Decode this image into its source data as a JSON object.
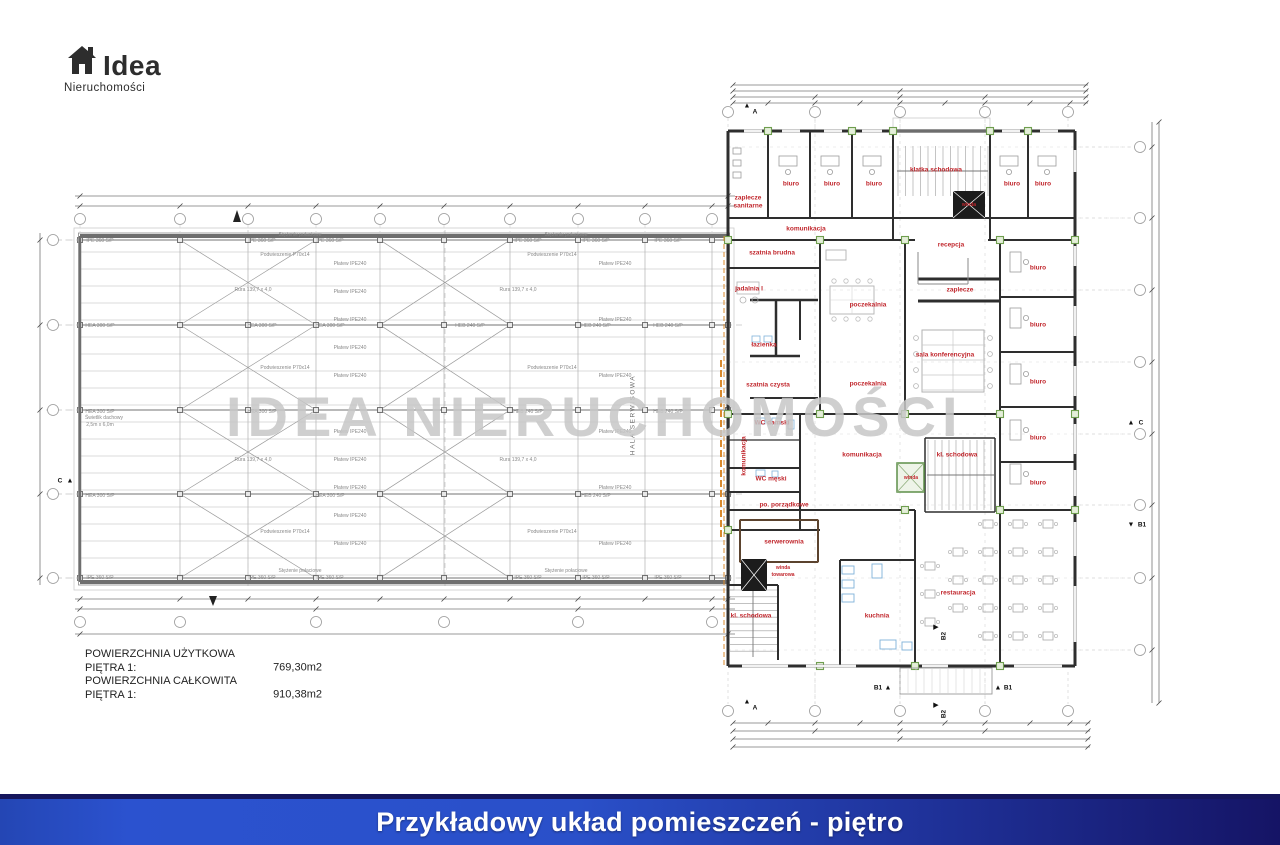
{
  "logo": {
    "brand": "Idea",
    "subtitle": "Nieruchomości"
  },
  "watermark": {
    "text": "IDEA NIERUCHOMOŚCI"
  },
  "summary": {
    "rows": [
      {
        "label": "POWIERZCHNIA UŻYTKOWA PIĘTRA 1:",
        "value": "769,30m2"
      },
      {
        "label": "POWIERZCHNIA CAŁKOWITA PIĘTRA 1:",
        "value": "910,38m2"
      }
    ]
  },
  "banner": {
    "text": "Przykładowy układ pomieszczeń - piętro"
  },
  "colors": {
    "room_label_red": "#c1272d",
    "banner_left": "#2b52cf",
    "banner_right": "#151465",
    "watermark_gray": "#c7c7c7",
    "green_marker": "#6f9e4f",
    "fire_line_orange": "#d98a2e"
  },
  "layers": {
    "rooms": [
      {
        "text": "zaplecze",
        "x": 748,
        "y": 198
      },
      {
        "text": "sanitarne",
        "x": 748,
        "y": 206
      },
      {
        "text": "biuro",
        "x": 791,
        "y": 184
      },
      {
        "text": "biuro",
        "x": 832,
        "y": 184
      },
      {
        "text": "biuro",
        "x": 874,
        "y": 184
      },
      {
        "text": "klatka schodowa",
        "x": 936,
        "y": 170
      },
      {
        "text": "biuro",
        "x": 1012,
        "y": 184
      },
      {
        "text": "biuro",
        "x": 1043,
        "y": 184
      },
      {
        "text": "winda",
        "x": 969,
        "y": 205,
        "cls": "tiny"
      },
      {
        "text": "komunikacja",
        "x": 806,
        "y": 229
      },
      {
        "text": "recepcja",
        "x": 951,
        "y": 245
      },
      {
        "text": "szatnia brudna",
        "x": 772,
        "y": 253
      },
      {
        "text": "jadalnia I",
        "x": 749,
        "y": 289
      },
      {
        "text": "zaplecze",
        "x": 960,
        "y": 290
      },
      {
        "text": "poczekalnia",
        "x": 868,
        "y": 305
      },
      {
        "text": "łazienka",
        "x": 764,
        "y": 345
      },
      {
        "text": "sala konferencyjna",
        "x": 945,
        "y": 355
      },
      {
        "text": "szatnia czysta",
        "x": 768,
        "y": 385
      },
      {
        "text": "poczekalnia",
        "x": 868,
        "y": 384
      },
      {
        "text": "biuro",
        "x": 1038,
        "y": 268
      },
      {
        "text": "biuro",
        "x": 1038,
        "y": 325
      },
      {
        "text": "biuro",
        "x": 1038,
        "y": 382
      },
      {
        "text": "biuro",
        "x": 1038,
        "y": 438
      },
      {
        "text": "biuro",
        "x": 1038,
        "y": 483
      },
      {
        "text": "WC damski",
        "x": 772,
        "y": 423
      },
      {
        "text": "komunikacja",
        "x": 862,
        "y": 455
      },
      {
        "text": "kl. schodowa",
        "x": 957,
        "y": 455
      },
      {
        "text": "WC męski",
        "x": 771,
        "y": 479
      },
      {
        "text": "winda",
        "x": 911,
        "y": 478,
        "cls": "tiny"
      },
      {
        "text": "po. porządkowe",
        "x": 784,
        "y": 505
      },
      {
        "text": "serwerownia",
        "x": 784,
        "y": 542
      },
      {
        "text": "winda",
        "x": 783,
        "y": 568,
        "cls": "tiny"
      },
      {
        "text": "towarowa",
        "x": 783,
        "y": 575,
        "cls": "tiny"
      },
      {
        "text": "kl. schodowa",
        "x": 751,
        "y": 616
      },
      {
        "text": "kuchnia",
        "x": 877,
        "y": 616
      },
      {
        "text": "restauracja",
        "x": 958,
        "y": 593
      },
      {
        "text": "komunikacja",
        "x": 744,
        "y": 456,
        "rot": -90
      }
    ],
    "annotations": [
      {
        "text": "IPE 360 S/P",
        "x": 100,
        "y": 241
      },
      {
        "text": "IPE 360 S/P",
        "x": 262,
        "y": 241
      },
      {
        "text": "IPE 360 S/P",
        "x": 330,
        "y": 241
      },
      {
        "text": "IPE 360 S/P",
        "x": 528,
        "y": 241
      },
      {
        "text": "IPE 360 S/P",
        "x": 596,
        "y": 241
      },
      {
        "text": "IPE 360 S/P",
        "x": 668,
        "y": 241
      },
      {
        "text": "Stężenie połaciowe",
        "x": 300,
        "y": 235
      },
      {
        "text": "Stężenie połaciowe",
        "x": 566,
        "y": 235
      },
      {
        "text": "Rura 139,7 x 4,0",
        "x": 253,
        "y": 290
      },
      {
        "text": "Rura 139,7 x 4,0",
        "x": 518,
        "y": 290
      },
      {
        "text": "Rura 139,7 x 4,0",
        "x": 253,
        "y": 460
      },
      {
        "text": "Rura 139,7 x 4,0",
        "x": 518,
        "y": 460
      },
      {
        "text": "Podwieszenie P70x14",
        "x": 285,
        "y": 255
      },
      {
        "text": "Podwieszenie P70x14",
        "x": 552,
        "y": 255
      },
      {
        "text": "Podwieszenie P70x14",
        "x": 285,
        "y": 368
      },
      {
        "text": "Podwieszenie P70x14",
        "x": 552,
        "y": 368
      },
      {
        "text": "Podwieszenie P70x14",
        "x": 285,
        "y": 532
      },
      {
        "text": "Podwieszenie P70x14",
        "x": 552,
        "y": 532
      },
      {
        "text": "HEA 300 S/P",
        "x": 100,
        "y": 326
      },
      {
        "text": "HEA 300 S/P",
        "x": 262,
        "y": 326
      },
      {
        "text": "HEA 300 S/P",
        "x": 330,
        "y": 326
      },
      {
        "text": "HEB 240 S/P",
        "x": 470,
        "y": 326
      },
      {
        "text": "HEB 240 S/P",
        "x": 596,
        "y": 326
      },
      {
        "text": "HEB 240 S/P",
        "x": 668,
        "y": 326
      },
      {
        "text": "HEA 300 S/P",
        "x": 100,
        "y": 412
      },
      {
        "text": "HEA 300 S/P",
        "x": 262,
        "y": 412
      },
      {
        "text": "HEB 240 S/P",
        "x": 528,
        "y": 412
      },
      {
        "text": "HEB 240 S/P",
        "x": 668,
        "y": 412
      },
      {
        "text": "HEA 300 S/P",
        "x": 100,
        "y": 496
      },
      {
        "text": "HEA 300 S/P",
        "x": 330,
        "y": 496
      },
      {
        "text": "HEB 240 S/P",
        "x": 596,
        "y": 496
      },
      {
        "text": "IPE 360 S/P",
        "x": 100,
        "y": 578
      },
      {
        "text": "IPE 360 S/P",
        "x": 262,
        "y": 578
      },
      {
        "text": "IPE 360 S/P",
        "x": 330,
        "y": 578
      },
      {
        "text": "IPE 360 S/P",
        "x": 528,
        "y": 578
      },
      {
        "text": "IPE 360 S/P",
        "x": 596,
        "y": 578
      },
      {
        "text": "IPE 360 S/P",
        "x": 668,
        "y": 578
      },
      {
        "text": "Stężenie połaciowe",
        "x": 300,
        "y": 571
      },
      {
        "text": "Stężenie połaciowe",
        "x": 566,
        "y": 571
      },
      {
        "text": "Płatew IPE240",
        "x": 350,
        "y": 264
      },
      {
        "text": "Płatew IPE240",
        "x": 350,
        "y": 292
      },
      {
        "text": "Płatew IPE240",
        "x": 350,
        "y": 320
      },
      {
        "text": "Płatew IPE240",
        "x": 350,
        "y": 348
      },
      {
        "text": "Płatew IPE240",
        "x": 350,
        "y": 376
      },
      {
        "text": "Płatew IPE240",
        "x": 350,
        "y": 432
      },
      {
        "text": "Płatew IPE240",
        "x": 350,
        "y": 460
      },
      {
        "text": "Płatew IPE240",
        "x": 350,
        "y": 488
      },
      {
        "text": "Płatew IPE240",
        "x": 350,
        "y": 516
      },
      {
        "text": "Płatew IPE240",
        "x": 350,
        "y": 544
      },
      {
        "text": "Płatew IPE240",
        "x": 615,
        "y": 264
      },
      {
        "text": "Płatew IPE240",
        "x": 615,
        "y": 320
      },
      {
        "text": "Płatew IPE240",
        "x": 615,
        "y": 376
      },
      {
        "text": "Płatew IPE240",
        "x": 615,
        "y": 432
      },
      {
        "text": "Płatew IPE240",
        "x": 615,
        "y": 488
      },
      {
        "text": "Płatew IPE240",
        "x": 615,
        "y": 544
      },
      {
        "text": "Świetlik dachowy",
        "x": 104,
        "y": 418
      },
      {
        "text": "2,5m x 6,0m",
        "x": 100,
        "y": 425
      },
      {
        "text": "HALA SERWISOWA",
        "x": 633,
        "y": 415,
        "rot": -90,
        "cls": "hallname",
        "name": "hall-name-label"
      }
    ],
    "markers": [
      {
        "text": "▲",
        "x": 747,
        "y": 106,
        "cls": "flag"
      },
      {
        "text": "A",
        "x": 755,
        "y": 112
      },
      {
        "text": "▲",
        "x": 747,
        "y": 702,
        "cls": "flag"
      },
      {
        "text": "A",
        "x": 755,
        "y": 708
      },
      {
        "text": "▶",
        "x": 936,
        "y": 627,
        "cls": "flag"
      },
      {
        "text": "B2",
        "x": 944,
        "y": 636,
        "rot": -90
      },
      {
        "text": "▶",
        "x": 936,
        "y": 705,
        "cls": "flag"
      },
      {
        "text": "B2",
        "x": 944,
        "y": 714,
        "rot": -90
      },
      {
        "text": "B1",
        "x": 878,
        "y": 688
      },
      {
        "text": "▲",
        "x": 888,
        "y": 688,
        "cls": "flag"
      },
      {
        "text": "▲",
        "x": 998,
        "y": 688,
        "cls": "flag"
      },
      {
        "text": "B1",
        "x": 1008,
        "y": 688
      },
      {
        "text": "C",
        "x": 60,
        "y": 481
      },
      {
        "text": "▲",
        "x": 70,
        "y": 481,
        "cls": "flag"
      },
      {
        "text": "▲",
        "x": 1131,
        "y": 423,
        "cls": "flag"
      },
      {
        "text": "C",
        "x": 1141,
        "y": 423
      },
      {
        "text": "▼",
        "x": 1131,
        "y": 525,
        "cls": "flag"
      },
      {
        "text": "B1",
        "x": 1142,
        "y": 525
      }
    ]
  }
}
